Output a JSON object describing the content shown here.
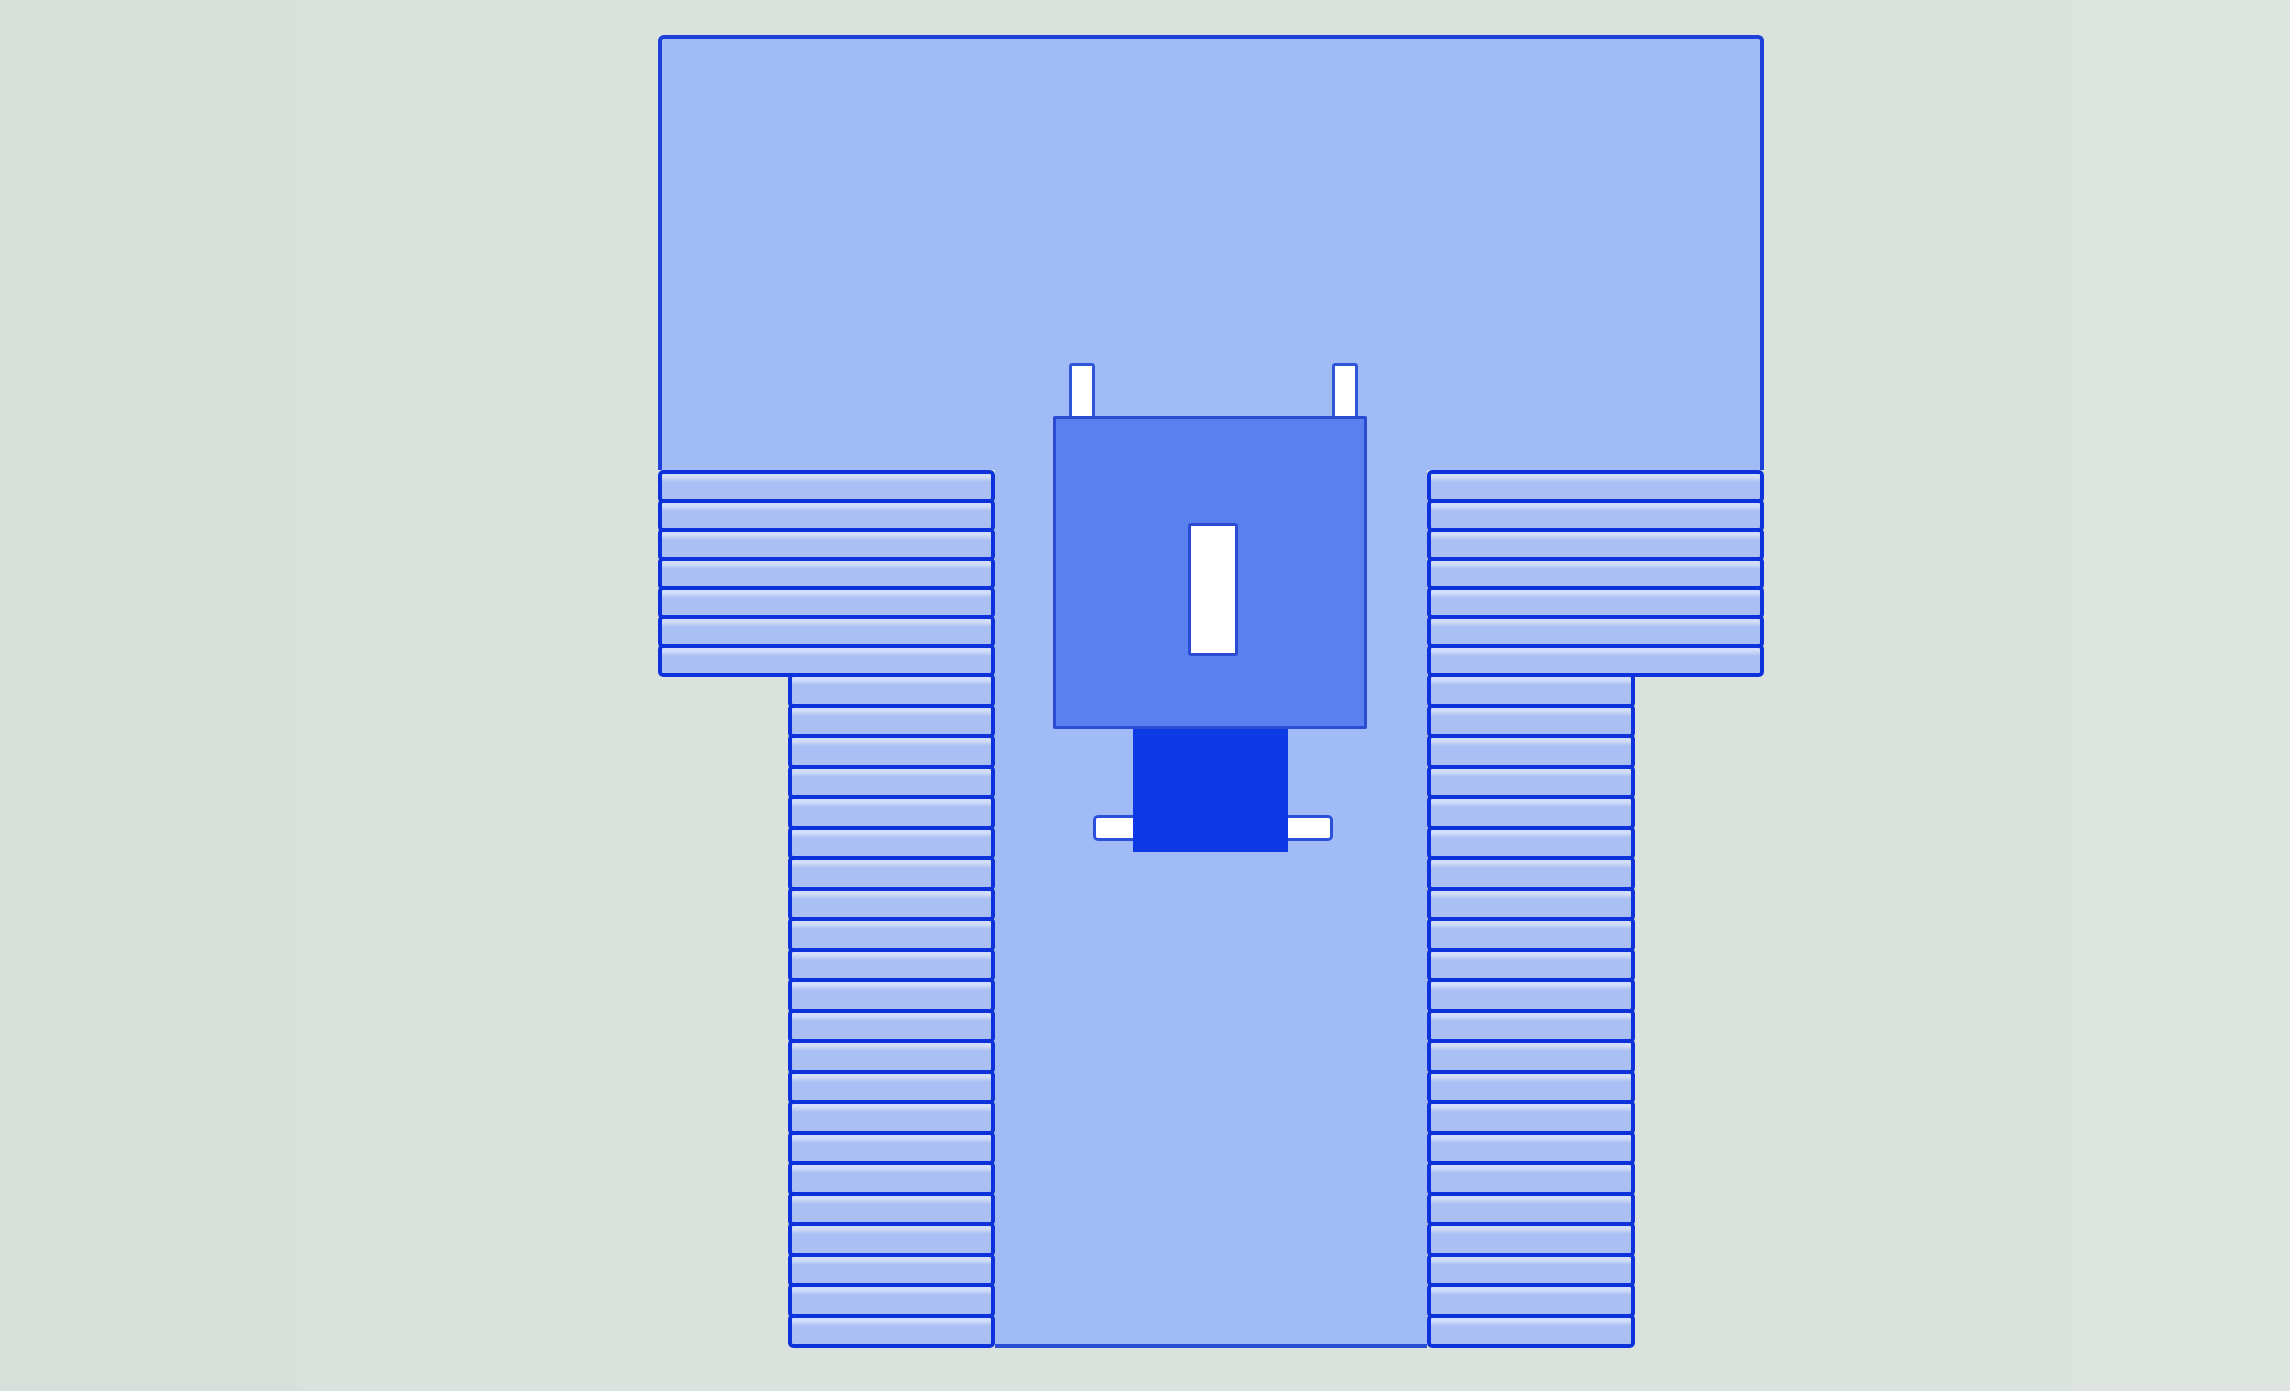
{
  "scene": {
    "type": "medical-product-diagram",
    "subject": "surgical drape with central fenestration, top view",
    "visible_text": []
  },
  "colors": {
    "bg_base": "#d9e2dc",
    "bg_left_strip": "#d6dfd9",
    "bg_right_strip": "#dee5e1",
    "drape_fill": "#a0bbf5",
    "drape_outline": "#1d41d8",
    "pleat_line": "#0d31da",
    "pleat_fill": "#aac0f4",
    "pleat_highlight": "#d2ddf9",
    "bottom_line": "#2a4fd4",
    "square_fill": "#5881ef",
    "square_border": "#2b4bd3",
    "slot_fill": "#ffffff",
    "tab_fill": "#ffffff",
    "tab_border": "#2f55d9",
    "bar_fill": "#ffffff",
    "bar_border": "#2b51dc",
    "pouch_fill": "#0e3ae6"
  },
  "drape": {
    "components": {
      "top_panel": "upper drape sheet",
      "center_panel": "central lower drape sheet",
      "fenestration_panel": "reinforced incise panel",
      "fenestration_slot": "fenestration opening",
      "tabs": [
        "left fixation tab",
        "right fixation tab"
      ],
      "pouch": "fluid collection pouch",
      "holder_bar": "tube holder bar"
    },
    "pleat_sections": {
      "left_upper": {
        "bands": 7,
        "label": "left upper fan-fold"
      },
      "left_lower": {
        "bands": 22,
        "label": "left lower fan-fold"
      },
      "right_upper": {
        "bands": 7,
        "label": "right upper fan-fold"
      },
      "right_lower": {
        "bands": 22,
        "label": "right lower fan-fold"
      }
    }
  }
}
